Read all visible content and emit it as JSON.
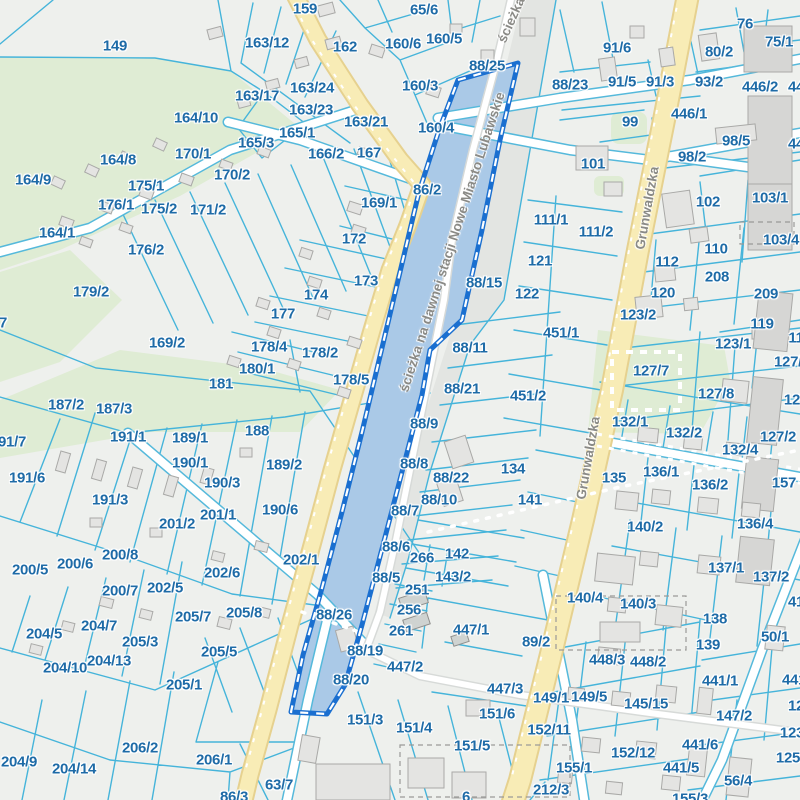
{
  "map": {
    "colors": {
      "background": "#eef0ed",
      "parcel_line": "#45b4da",
      "label": "#1e6ba7",
      "street_label": "#8a8a86",
      "green_area": "#dfecd4",
      "road_yellow": "#f8ecb6",
      "road_yellow_edge": "#e6d18f",
      "road_white": "#ffffff",
      "water_selection_fill": "#aac9e7",
      "selection_border": "#1a6fd0",
      "selection_dash": "#ffffff",
      "building_fill": "#e4e4e2",
      "building_stroke": "#a9a9a7",
      "rail_band": "#e3e5e2"
    },
    "street_labels": [
      {
        "text": "Grunwaldzka",
        "x": 647,
        "y": 208,
        "rot": -80
      },
      {
        "text": "Grunwaldzka",
        "x": 588,
        "y": 458,
        "rot": -80
      },
      {
        "text": "ścieżka na dawnej stacji Nowe Miasto Lubawskie",
        "x": 452,
        "y": 242,
        "rot": -72
      },
      {
        "text": "ścieżka",
        "x": 511,
        "y": 20,
        "rot": -66
      }
    ],
    "selected_parcel_labels": [
      "88/25",
      "88/26"
    ],
    "parcel_labels": [
      {
        "t": "149",
        "x": 115,
        "y": 46
      },
      {
        "t": "159",
        "x": 305,
        "y": 9
      },
      {
        "t": "65/6",
        "x": 424,
        "y": 10
      },
      {
        "t": "163/12",
        "x": 267,
        "y": 43
      },
      {
        "t": "162",
        "x": 345,
        "y": 47
      },
      {
        "t": "160/6",
        "x": 403,
        "y": 44
      },
      {
        "t": "160/5",
        "x": 444,
        "y": 39
      },
      {
        "t": "88/25",
        "x": 487,
        "y": 66
      },
      {
        "t": "163/24",
        "x": 312,
        "y": 88
      },
      {
        "t": "163/17",
        "x": 257,
        "y": 96
      },
      {
        "t": "160/3",
        "x": 420,
        "y": 86
      },
      {
        "t": "88/23",
        "x": 570,
        "y": 85
      },
      {
        "t": "164/10",
        "x": 196,
        "y": 118
      },
      {
        "t": "163/23",
        "x": 311,
        "y": 110
      },
      {
        "t": "163/21",
        "x": 366,
        "y": 122
      },
      {
        "t": "165/1",
        "x": 297,
        "y": 133
      },
      {
        "t": "160/4",
        "x": 436,
        "y": 128
      },
      {
        "t": "164/8",
        "x": 118,
        "y": 160
      },
      {
        "t": "170/1",
        "x": 193,
        "y": 154
      },
      {
        "t": "165/3",
        "x": 256,
        "y": 143
      },
      {
        "t": "164/9",
        "x": 33,
        "y": 180
      },
      {
        "t": "166/2",
        "x": 326,
        "y": 154
      },
      {
        "t": "167",
        "x": 369,
        "y": 153
      },
      {
        "t": "170/2",
        "x": 232,
        "y": 175
      },
      {
        "t": "175/1",
        "x": 146,
        "y": 186
      },
      {
        "t": "86/2",
        "x": 427,
        "y": 190
      },
      {
        "t": "176/1",
        "x": 116,
        "y": 205
      },
      {
        "t": "175/2",
        "x": 159,
        "y": 209
      },
      {
        "t": "171/2",
        "x": 208,
        "y": 210
      },
      {
        "t": "164/1",
        "x": 57,
        "y": 233
      },
      {
        "t": "169/1",
        "x": 379,
        "y": 203
      },
      {
        "t": "176/2",
        "x": 146,
        "y": 250
      },
      {
        "t": "172",
        "x": 354,
        "y": 239
      },
      {
        "t": "179/2",
        "x": 91,
        "y": 292
      },
      {
        "t": "173",
        "x": 366,
        "y": 281
      },
      {
        "t": "174",
        "x": 316,
        "y": 295
      },
      {
        "t": "177",
        "x": 283,
        "y": 314
      },
      {
        "t": "178/4",
        "x": 269,
        "y": 347
      },
      {
        "t": "178/2",
        "x": 320,
        "y": 353
      },
      {
        "t": "180/1",
        "x": 257,
        "y": 369
      },
      {
        "t": "178/5",
        "x": 351,
        "y": 380
      },
      {
        "t": "181",
        "x": 221,
        "y": 384
      },
      {
        "t": "169/2",
        "x": 167,
        "y": 343
      },
      {
        "t": "7",
        "x": 3,
        "y": 323
      },
      {
        "t": "91/6",
        "x": 617,
        "y": 48
      },
      {
        "t": "76",
        "x": 745,
        "y": 24
      },
      {
        "t": "75/1",
        "x": 779,
        "y": 42
      },
      {
        "t": "80/2",
        "x": 719,
        "y": 52
      },
      {
        "t": "91/5",
        "x": 622,
        "y": 82
      },
      {
        "t": "91/3",
        "x": 660,
        "y": 82
      },
      {
        "t": "93/2",
        "x": 709,
        "y": 82
      },
      {
        "t": "446/2",
        "x": 760,
        "y": 87
      },
      {
        "t": "44",
        "x": 796,
        "y": 87
      },
      {
        "t": "99",
        "x": 630,
        "y": 122
      },
      {
        "t": "446/1",
        "x": 689,
        "y": 114
      },
      {
        "t": "98/5",
        "x": 736,
        "y": 141
      },
      {
        "t": "44",
        "x": 796,
        "y": 144
      },
      {
        "t": "98/2",
        "x": 692,
        "y": 157
      },
      {
        "t": "101",
        "x": 593,
        "y": 164
      },
      {
        "t": "102",
        "x": 708,
        "y": 202
      },
      {
        "t": "103/1",
        "x": 770,
        "y": 198
      },
      {
        "t": "103/4",
        "x": 781,
        "y": 240
      },
      {
        "t": "110",
        "x": 716,
        "y": 249
      },
      {
        "t": "111/1",
        "x": 551,
        "y": 220
      },
      {
        "t": "111/2",
        "x": 596,
        "y": 232
      },
      {
        "t": "121",
        "x": 540,
        "y": 261
      },
      {
        "t": "112",
        "x": 667,
        "y": 262
      },
      {
        "t": "208",
        "x": 717,
        "y": 277
      },
      {
        "t": "120",
        "x": 663,
        "y": 293
      },
      {
        "t": "209",
        "x": 766,
        "y": 294
      },
      {
        "t": "122",
        "x": 527,
        "y": 294
      },
      {
        "t": "88/15",
        "x": 484,
        "y": 283
      },
      {
        "t": "123/2",
        "x": 638,
        "y": 315
      },
      {
        "t": "119",
        "x": 762,
        "y": 324
      },
      {
        "t": "451/1",
        "x": 561,
        "y": 333
      },
      {
        "t": "88/11",
        "x": 470,
        "y": 348
      },
      {
        "t": "123/1",
        "x": 733,
        "y": 344
      },
      {
        "t": "11",
        "x": 796,
        "y": 338
      },
      {
        "t": "127/",
        "x": 788,
        "y": 362
      },
      {
        "t": "127/7",
        "x": 651,
        "y": 371
      },
      {
        "t": "88/21",
        "x": 462,
        "y": 389
      },
      {
        "t": "451/2",
        "x": 528,
        "y": 396
      },
      {
        "t": "127/8",
        "x": 716,
        "y": 394
      },
      {
        "t": "127",
        "x": 796,
        "y": 400
      },
      {
        "t": "187/2",
        "x": 66,
        "y": 405
      },
      {
        "t": "187/3",
        "x": 114,
        "y": 409
      },
      {
        "t": "88/9",
        "x": 424,
        "y": 424
      },
      {
        "t": "132/1",
        "x": 630,
        "y": 422
      },
      {
        "t": "132/2",
        "x": 684,
        "y": 433
      },
      {
        "t": "127/2",
        "x": 778,
        "y": 437
      },
      {
        "t": "191/1",
        "x": 128,
        "y": 437
      },
      {
        "t": "189/1",
        "x": 190,
        "y": 438
      },
      {
        "t": "188",
        "x": 257,
        "y": 431
      },
      {
        "t": "191/7",
        "x": 8,
        "y": 442
      },
      {
        "t": "132/4",
        "x": 740,
        "y": 450
      },
      {
        "t": "190/1",
        "x": 190,
        "y": 463
      },
      {
        "t": "191/6",
        "x": 27,
        "y": 478
      },
      {
        "t": "189/2",
        "x": 284,
        "y": 465
      },
      {
        "t": "88/8",
        "x": 414,
        "y": 464
      },
      {
        "t": "134",
        "x": 513,
        "y": 469
      },
      {
        "t": "88/22",
        "x": 451,
        "y": 478
      },
      {
        "t": "135",
        "x": 614,
        "y": 478
      },
      {
        "t": "136/1",
        "x": 661,
        "y": 472
      },
      {
        "t": "157",
        "x": 784,
        "y": 483
      },
      {
        "t": "136/2",
        "x": 710,
        "y": 485
      },
      {
        "t": "190/3",
        "x": 222,
        "y": 483
      },
      {
        "t": "88/10",
        "x": 439,
        "y": 500
      },
      {
        "t": "141",
        "x": 530,
        "y": 500
      },
      {
        "t": "191/3",
        "x": 110,
        "y": 500
      },
      {
        "t": "190/6",
        "x": 280,
        "y": 510
      },
      {
        "t": "88/7",
        "x": 405,
        "y": 511
      },
      {
        "t": "201/1",
        "x": 218,
        "y": 515
      },
      {
        "t": "201/2",
        "x": 177,
        "y": 524
      },
      {
        "t": "136/4",
        "x": 755,
        "y": 524
      },
      {
        "t": "140/2",
        "x": 645,
        "y": 527
      },
      {
        "t": "88/6",
        "x": 396,
        "y": 547
      },
      {
        "t": "266",
        "x": 422,
        "y": 558
      },
      {
        "t": "142",
        "x": 457,
        "y": 554
      },
      {
        "t": "200/8",
        "x": 120,
        "y": 555
      },
      {
        "t": "200/6",
        "x": 75,
        "y": 564
      },
      {
        "t": "200/5",
        "x": 30,
        "y": 570
      },
      {
        "t": "202/6",
        "x": 222,
        "y": 573
      },
      {
        "t": "202/1",
        "x": 301,
        "y": 560
      },
      {
        "t": "88/5",
        "x": 386,
        "y": 578
      },
      {
        "t": "143/2",
        "x": 453,
        "y": 577
      },
      {
        "t": "137/1",
        "x": 726,
        "y": 568
      },
      {
        "t": "137/2",
        "x": 771,
        "y": 577
      },
      {
        "t": "202/5",
        "x": 165,
        "y": 588
      },
      {
        "t": "205/7",
        "x": 193,
        "y": 617
      },
      {
        "t": "205/8",
        "x": 244,
        "y": 613
      },
      {
        "t": "204/7",
        "x": 99,
        "y": 626
      },
      {
        "t": "204/5",
        "x": 44,
        "y": 634
      },
      {
        "t": "251",
        "x": 417,
        "y": 590
      },
      {
        "t": "200/7",
        "x": 120,
        "y": 591
      },
      {
        "t": "256",
        "x": 409,
        "y": 610
      },
      {
        "t": "88/26",
        "x": 334,
        "y": 615
      },
      {
        "t": "261",
        "x": 401,
        "y": 631
      },
      {
        "t": "447/1",
        "x": 471,
        "y": 630
      },
      {
        "t": "89/2",
        "x": 536,
        "y": 642
      },
      {
        "t": "205/3",
        "x": 140,
        "y": 642
      },
      {
        "t": "205/5",
        "x": 219,
        "y": 652
      },
      {
        "t": "88/19",
        "x": 365,
        "y": 651
      },
      {
        "t": "204/10",
        "x": 65,
        "y": 668
      },
      {
        "t": "204/13",
        "x": 109,
        "y": 661
      },
      {
        "t": "447/2",
        "x": 405,
        "y": 667
      },
      {
        "t": "88/20",
        "x": 351,
        "y": 680
      },
      {
        "t": "205/1",
        "x": 184,
        "y": 685
      },
      {
        "t": "447/3",
        "x": 505,
        "y": 689
      },
      {
        "t": "140/4",
        "x": 585,
        "y": 598
      },
      {
        "t": "140/3",
        "x": 638,
        "y": 604
      },
      {
        "t": "138",
        "x": 715,
        "y": 619
      },
      {
        "t": "50/1",
        "x": 775,
        "y": 637
      },
      {
        "t": "139",
        "x": 708,
        "y": 645
      },
      {
        "t": "41",
        "x": 796,
        "y": 602
      },
      {
        "t": "448/3",
        "x": 607,
        "y": 660
      },
      {
        "t": "448/2",
        "x": 648,
        "y": 662
      },
      {
        "t": "441/1",
        "x": 720,
        "y": 681
      },
      {
        "t": "149/1",
        "x": 551,
        "y": 698
      },
      {
        "t": "149/5",
        "x": 589,
        "y": 697
      },
      {
        "t": "145/15",
        "x": 646,
        "y": 704
      },
      {
        "t": "147/2",
        "x": 734,
        "y": 716
      },
      {
        "t": "12",
        "x": 796,
        "y": 706
      },
      {
        "t": "151/6",
        "x": 497,
        "y": 714
      },
      {
        "t": "151/3",
        "x": 365,
        "y": 720
      },
      {
        "t": "151/4",
        "x": 414,
        "y": 728
      },
      {
        "t": "152/11",
        "x": 549,
        "y": 730
      },
      {
        "t": "123",
        "x": 792,
        "y": 733
      },
      {
        "t": "206/2",
        "x": 140,
        "y": 748
      },
      {
        "t": "151/5",
        "x": 472,
        "y": 746
      },
      {
        "t": "152/12",
        "x": 633,
        "y": 753
      },
      {
        "t": "441/6",
        "x": 700,
        "y": 745
      },
      {
        "t": "125",
        "x": 788,
        "y": 758
      },
      {
        "t": "204/9",
        "x": 19,
        "y": 762
      },
      {
        "t": "204/14",
        "x": 74,
        "y": 769
      },
      {
        "t": "206/1",
        "x": 214,
        "y": 760
      },
      {
        "t": "441/5",
        "x": 681,
        "y": 768
      },
      {
        "t": "155/1",
        "x": 574,
        "y": 768
      },
      {
        "t": "56/4",
        "x": 738,
        "y": 781
      },
      {
        "t": "63/7",
        "x": 279,
        "y": 785
      },
      {
        "t": "212/3",
        "x": 551,
        "y": 790
      },
      {
        "t": "86/3",
        "x": 234,
        "y": 797
      },
      {
        "t": "155/3",
        "x": 690,
        "y": 799
      },
      {
        "t": "6",
        "x": 466,
        "y": 797
      },
      {
        "t": "441/",
        "x": 796,
        "y": 680
      }
    ]
  }
}
